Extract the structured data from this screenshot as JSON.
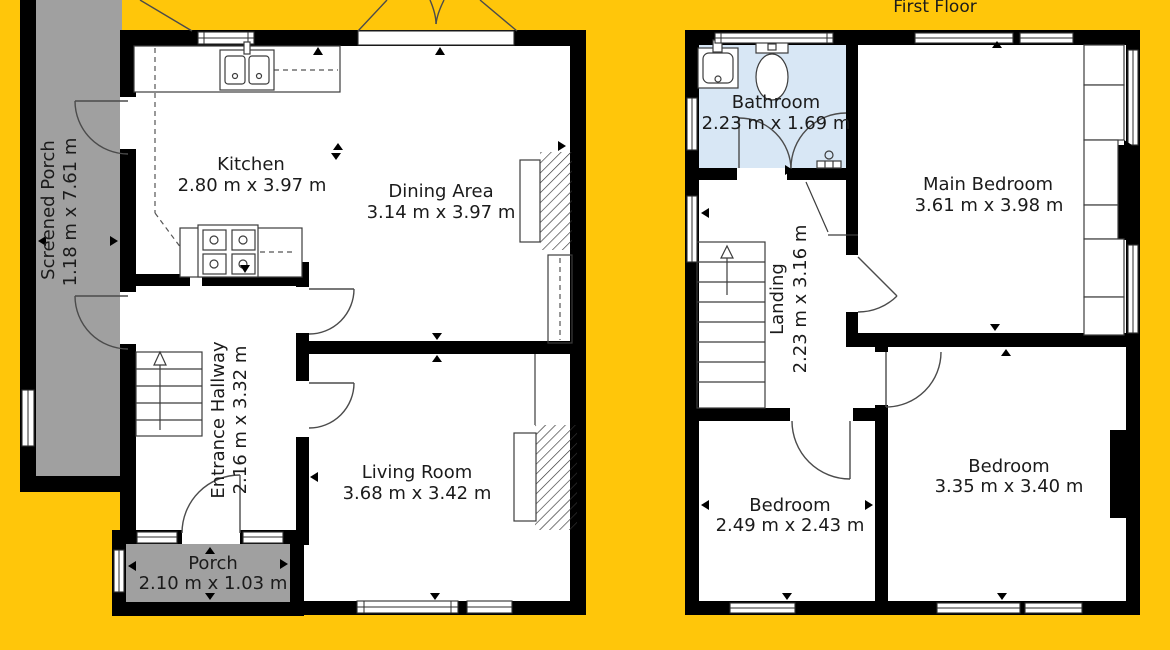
{
  "page": {
    "type": "floorplan"
  },
  "first_floor_title": "First Floor",
  "ground_floor": {
    "rooms": {
      "screened_porch": {
        "name": "Screened Porch",
        "dimensions": "1.18 m x 7.61 m"
      },
      "kitchen": {
        "name": "Kitchen",
        "dimensions": "2.80 m x 3.97 m"
      },
      "dining_area": {
        "name": "Dining Area",
        "dimensions": "3.14 m x 3.97 m"
      },
      "entrance_hallway": {
        "name": "Entrance Hallway",
        "dimensions": "2.16 m x 3.32 m"
      },
      "living_room": {
        "name": "Living Room",
        "dimensions": "3.68 m x 3.42 m"
      },
      "porch": {
        "name": "Porch",
        "dimensions": "2.10 m x 1.03 m"
      }
    }
  },
  "first_floor": {
    "rooms": {
      "bathroom": {
        "name": "Bathroom",
        "dimensions": "2.23 m x 1.69 m"
      },
      "main_bedroom": {
        "name": "Main Bedroom",
        "dimensions": "3.61 m x 3.98 m"
      },
      "landing": {
        "name": "Landing",
        "dimensions": "2.23 m x 3.16 m"
      },
      "bedroom_left": {
        "name": "Bedroom",
        "dimensions": "2.49 m x 2.43 m"
      },
      "bedroom_right": {
        "name": "Bedroom",
        "dimensions": "3.35 m x 3.40 m"
      }
    }
  },
  "colors": {
    "background": "#FFC60A",
    "porch_fill": "#A0A0A0",
    "bathroom_fill": "#D8E7F5",
    "wall": "#000000"
  }
}
